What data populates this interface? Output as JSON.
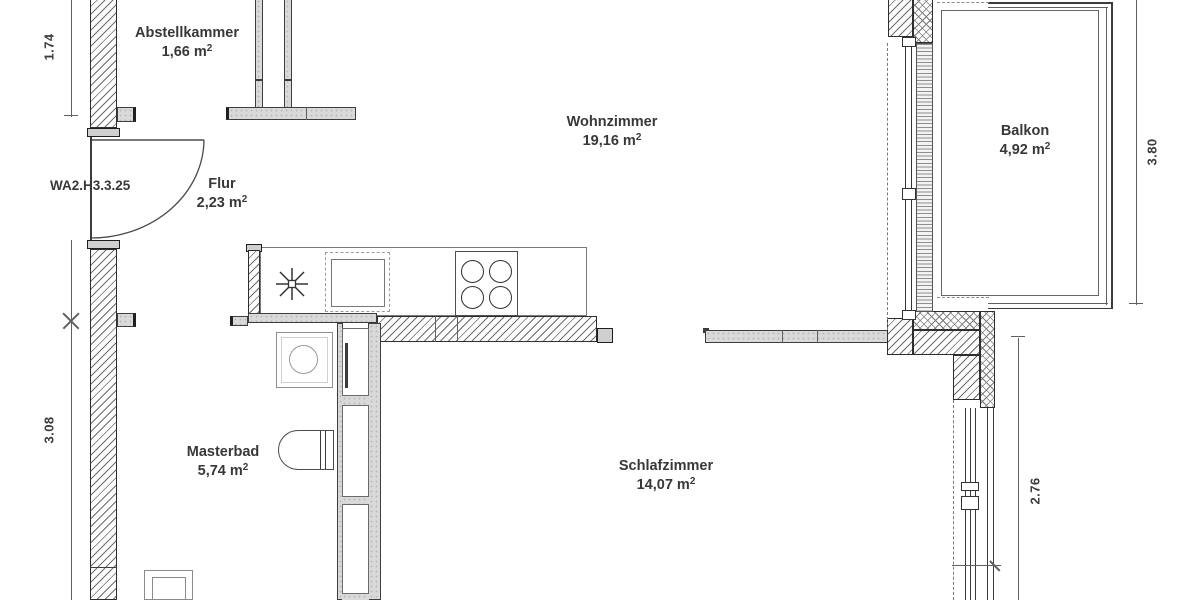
{
  "plan": {
    "unit_code": "WA2.H3.3.25",
    "rooms": [
      {
        "id": "abstellkammer",
        "name": "Abstellkammer",
        "area": "1,66 m",
        "sup": "2"
      },
      {
        "id": "flur",
        "name": "Flur",
        "area": "2,23 m",
        "sup": "2"
      },
      {
        "id": "wohnzimmer",
        "name": "Wohnzimmer",
        "area": "19,16 m",
        "sup": "2"
      },
      {
        "id": "balkon",
        "name": "Balkon",
        "area": "4,92 m",
        "sup": "2"
      },
      {
        "id": "masterbad",
        "name": "Masterbad",
        "area": "5,74 m",
        "sup": "2"
      },
      {
        "id": "schlafzimmer",
        "name": "Schlafzimmer",
        "area": "14,07 m",
        "sup": "2"
      }
    ],
    "dimensions": {
      "left_top": "1.74",
      "left_bottom": "3.08",
      "right_balcony": "3.80",
      "right_bedroom": "2.76"
    },
    "fixtures": {
      "stove": "stove-4-burner-icon",
      "sink": "kitchen-sink-icon",
      "drain": "star-drain-icon",
      "washing_machine": "washing-machine-icon",
      "toilet": "toilet-icon",
      "washbasin": "washbasin-icon",
      "door": "door-swing-arc"
    },
    "colors": {
      "wall_fill": "#d9d9d9",
      "line": "#333333",
      "text": "#3a3a3a",
      "background": "#ffffff"
    }
  }
}
